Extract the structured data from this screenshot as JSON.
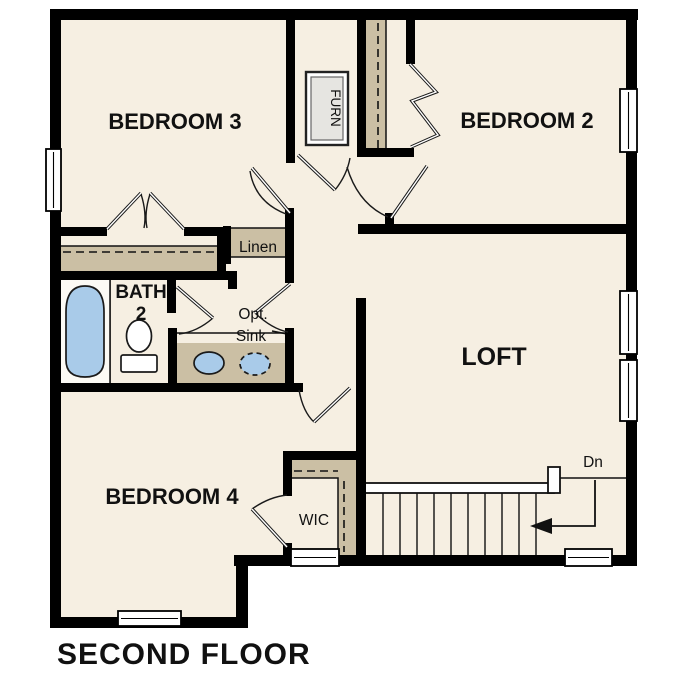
{
  "title": "SECOND FLOOR",
  "rooms": {
    "bedroom3": "BEDROOM 3",
    "bedroom2": "BEDROOM 2",
    "loft": "LOFT",
    "bedroom4": "BEDROOM 4",
    "bath_line1": "BATH",
    "bath_line2": "2",
    "wic": "WIC",
    "linen": "Linen",
    "furnace": "FURN"
  },
  "annotations": {
    "opt_sink_line1": "Opt.",
    "opt_sink_line2": "Sink",
    "stairs_direction": "Dn"
  },
  "stairs": {
    "tread_count": 11,
    "direction_label": "Dn"
  },
  "fixtures": [
    "tub",
    "toilet",
    "vanity-sink",
    "optional-sink",
    "furnace"
  ],
  "colors": {
    "floor": "#F6EFE2",
    "closet": "#CBBFA4",
    "wall": "#000000",
    "fixture_blue": "#A9CBE9",
    "furnace_fill": "#E6E5E1",
    "background": "#FFFFFF",
    "text": "#111111"
  }
}
